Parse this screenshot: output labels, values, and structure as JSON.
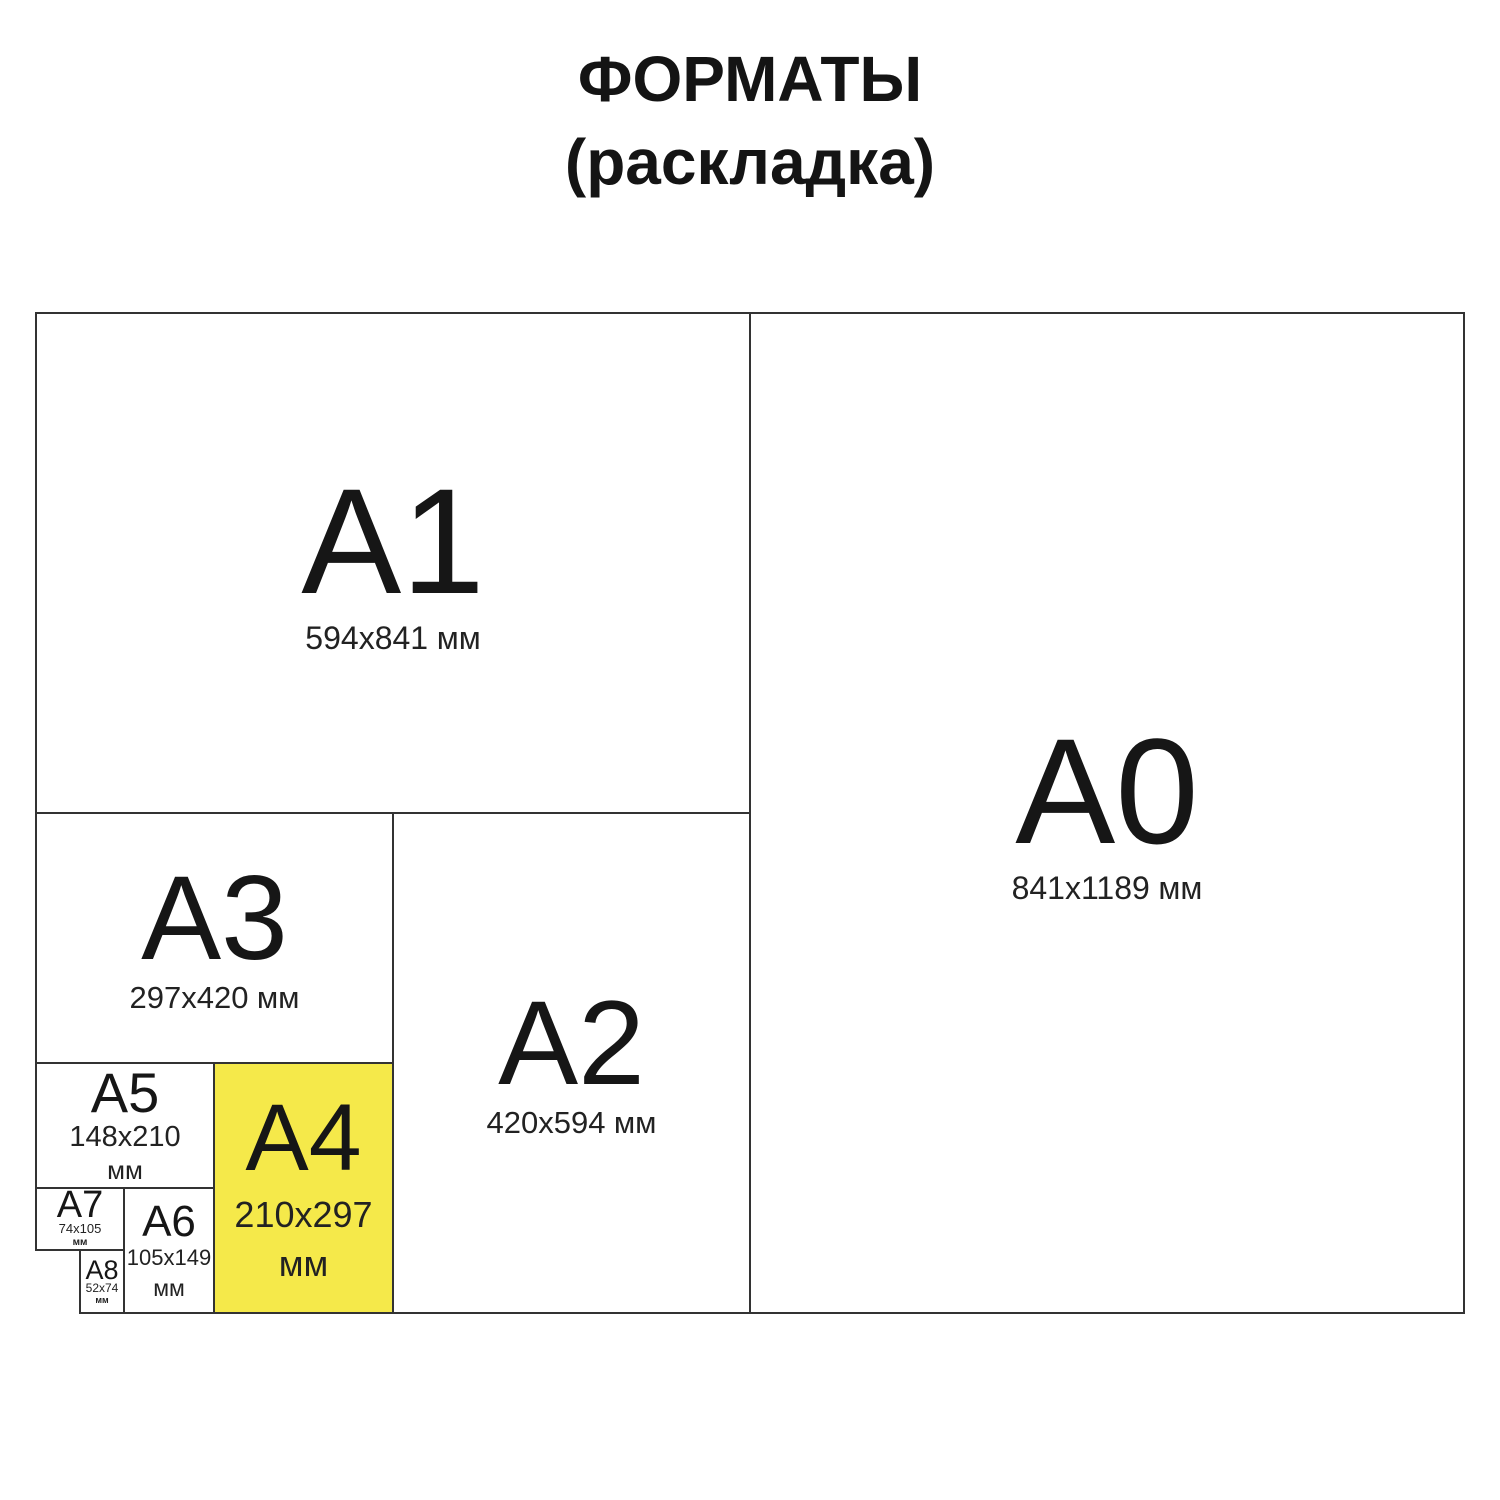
{
  "title": {
    "line1": "ФОРМАТЫ",
    "line2": "(раскладка)"
  },
  "formats": {
    "a0": {
      "label": "A0",
      "dims": "841x1189",
      "unit": "мм"
    },
    "a1": {
      "label": "A1",
      "dims": "594x841",
      "unit": "мм"
    },
    "a2": {
      "label": "A2",
      "dims": "420x594",
      "unit": "мм"
    },
    "a3": {
      "label": "A3",
      "dims": "297x420",
      "unit": "мм"
    },
    "a4": {
      "label": "A4",
      "dims": "210x297",
      "unit": "мм",
      "highlighted": true
    },
    "a5": {
      "label": "A5",
      "dims": "148x210",
      "unit": "мм"
    },
    "a6": {
      "label": "A6",
      "dims": "105x149",
      "unit": "мм"
    },
    "a7": {
      "label": "A7",
      "dims": "74x105",
      "unit": "мм"
    },
    "a8": {
      "label": "A8",
      "dims": "52x74",
      "unit": "мм"
    }
  },
  "colors": {
    "highlight": "#f5e94a",
    "line": "#333333",
    "text": "#1b1b1b",
    "background": "#ffffff"
  }
}
